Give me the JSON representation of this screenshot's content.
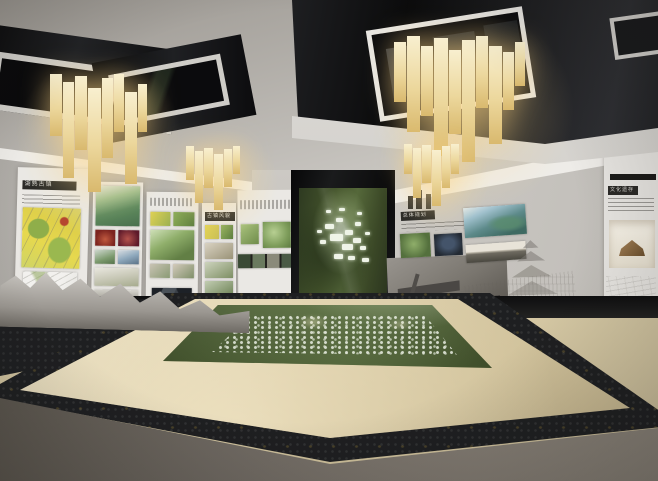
{
  "scene": {
    "subject": "Urban planning exhibition hall — 3D interior rendering",
    "features": [
      "coffered ceiling with black mirror panels",
      "timber-slat chandeliers",
      "wall exhibition panels with zoning maps and photos",
      "central media wall showing a green aerial map with white building clusters",
      "sunken glass-covered site model in a beige granite-edged platform",
      "white city relief model along left wall base",
      "line-art heritage murals and pagoda sketch on right wall",
      "display niche with wooden artifact model"
    ]
  },
  "panels": {
    "p1_title": "湖熟古镇",
    "p4_title": "古镇风貌",
    "r1_title": "总体规划",
    "p6_title": "文化遗存"
  },
  "palette": {
    "coffer": "#121214",
    "trim": "#dcdad6",
    "slatLight": "#f8efcf",
    "slatMid": "#ecd79c",
    "slatDark": "#d9b96e",
    "glow": "#ffd682",
    "wall": "#c9c6c1",
    "wallBright": "#eeece8",
    "panel": "#eae8e4",
    "headerBar": "#2b2a27",
    "headerText": "#d9d7d2",
    "mapYellow": "#e6d84e",
    "mapGreen": "#7fa24c",
    "photoRed": "#93352c",
    "photoNight": "#232a33",
    "screenFrame": "#0b0b0c",
    "screenGreen": "#45552c",
    "screenGreenDark": "#2b351f",
    "clusterWhite": "#eef3e7",
    "floorBeige": "#e5d9b8",
    "floorBeigeDark": "#c6b68d",
    "granite": "#1e1f21",
    "foreground": "#6e6861",
    "darkStrip": "#131314",
    "relief": "#cfccc7",
    "sketch": "#8a8680",
    "wood": "#8a6a42"
  }
}
